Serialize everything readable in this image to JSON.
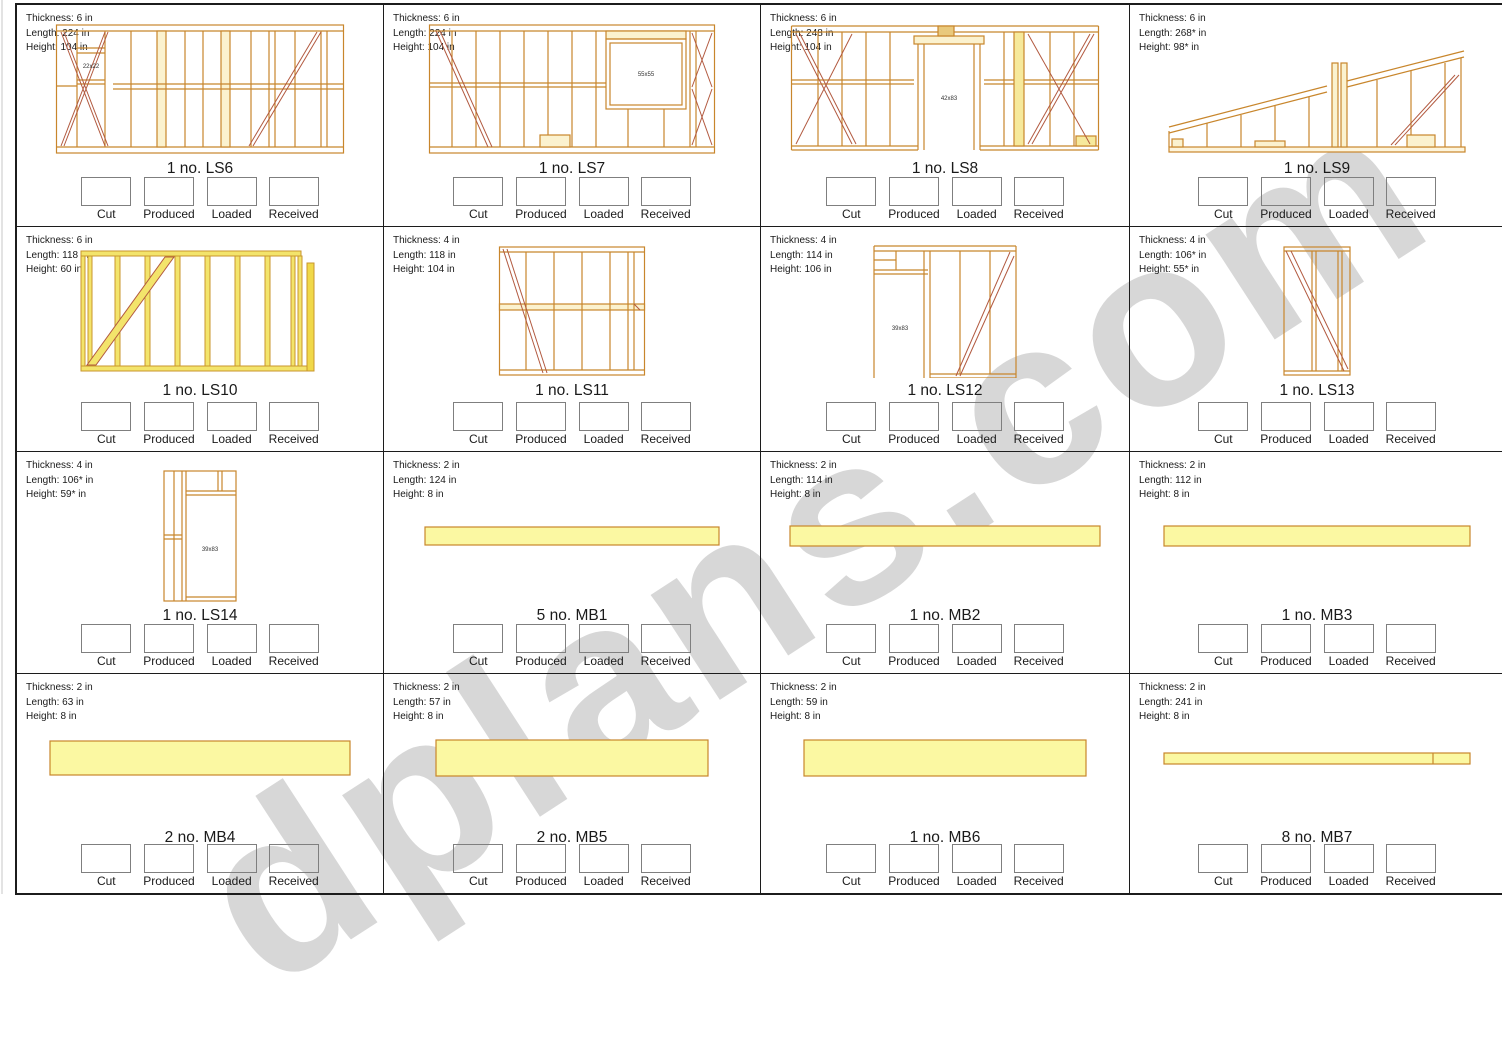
{
  "watermark": "dplans.com",
  "colors": {
    "frame_outline": "#c8862c",
    "brace": "#b25a40",
    "beam_fill": "#fbf8a2",
    "stud_cream_fill": "#fbf2cf",
    "stud_yellow_fill": "#f3e46b",
    "grid_line": "#1c1c1c",
    "checkbox_border": "#7f7f7f"
  },
  "checkbox_labels": {
    "cut": "Cut",
    "produced": "Produced",
    "loaded": "Loaded",
    "received": "Received"
  },
  "panels": [
    {
      "id": "LS6",
      "thickness": "Thickness: 6 in",
      "length": "Length: 224 in",
      "height": "Height: 104 in",
      "label": "1 no. LS6",
      "opening": "22x22"
    },
    {
      "id": "LS7",
      "thickness": "Thickness: 6 in",
      "length": "Length: 224 in",
      "height": "Height: 104 in",
      "label": "1 no. LS7",
      "opening": "55x55"
    },
    {
      "id": "LS8",
      "thickness": "Thickness: 6 in",
      "length": "Length: 248 in",
      "height": "Height: 104 in",
      "label": "1 no. LS8",
      "opening": "42x83"
    },
    {
      "id": "LS9",
      "thickness": "Thickness: 6 in",
      "length": "Length: 268* in",
      "height": "Height: 98* in",
      "label": "1 no. LS9"
    },
    {
      "id": "LS10",
      "thickness": "Thickness: 6 in",
      "length": "Length: 118 in",
      "height": "Height: 60 in",
      "label": "1 no. LS10"
    },
    {
      "id": "LS11",
      "thickness": "Thickness: 4 in",
      "length": "Length: 118 in",
      "height": "Height: 104 in",
      "label": "1 no. LS11"
    },
    {
      "id": "LS12",
      "thickness": "Thickness: 4 in",
      "length": "Length: 114 in",
      "height": "Height: 106 in",
      "label": "1 no. LS12",
      "opening": "39x83"
    },
    {
      "id": "LS13",
      "thickness": "Thickness: 4 in",
      "length": "Length: 106* in",
      "height": "Height: 55* in",
      "label": "1 no. LS13"
    },
    {
      "id": "LS14",
      "thickness": "Thickness: 4 in",
      "length": "Length: 106* in",
      "height": "Height: 59* in",
      "label": "1 no. LS14",
      "opening": "39x83"
    },
    {
      "id": "MB1",
      "thickness": "Thickness: 2 in",
      "length": "Length: 124 in",
      "height": "Height: 8 in",
      "label": "5 no. MB1"
    },
    {
      "id": "MB2",
      "thickness": "Thickness: 2 in",
      "length": "Length: 114 in",
      "height": "Height: 8 in",
      "label": "1 no. MB2"
    },
    {
      "id": "MB3",
      "thickness": "Thickness: 2 in",
      "length": "Length: 112 in",
      "height": "Height: 8 in",
      "label": "1 no. MB3"
    },
    {
      "id": "MB4",
      "thickness": "Thickness: 2 in",
      "length": "Length: 63 in",
      "height": "Height: 8 in",
      "label": "2 no. MB4"
    },
    {
      "id": "MB5",
      "thickness": "Thickness: 2 in",
      "length": "Length: 57 in",
      "height": "Height: 8 in",
      "label": "2 no. MB5"
    },
    {
      "id": "MB6",
      "thickness": "Thickness: 2 in",
      "length": "Length: 59 in",
      "height": "Height: 8 in",
      "label": "1 no. MB6"
    },
    {
      "id": "MB7",
      "thickness": "Thickness: 2 in",
      "length": "Length: 241 in",
      "height": "Height: 8 in",
      "label": "8 no. MB7"
    }
  ]
}
